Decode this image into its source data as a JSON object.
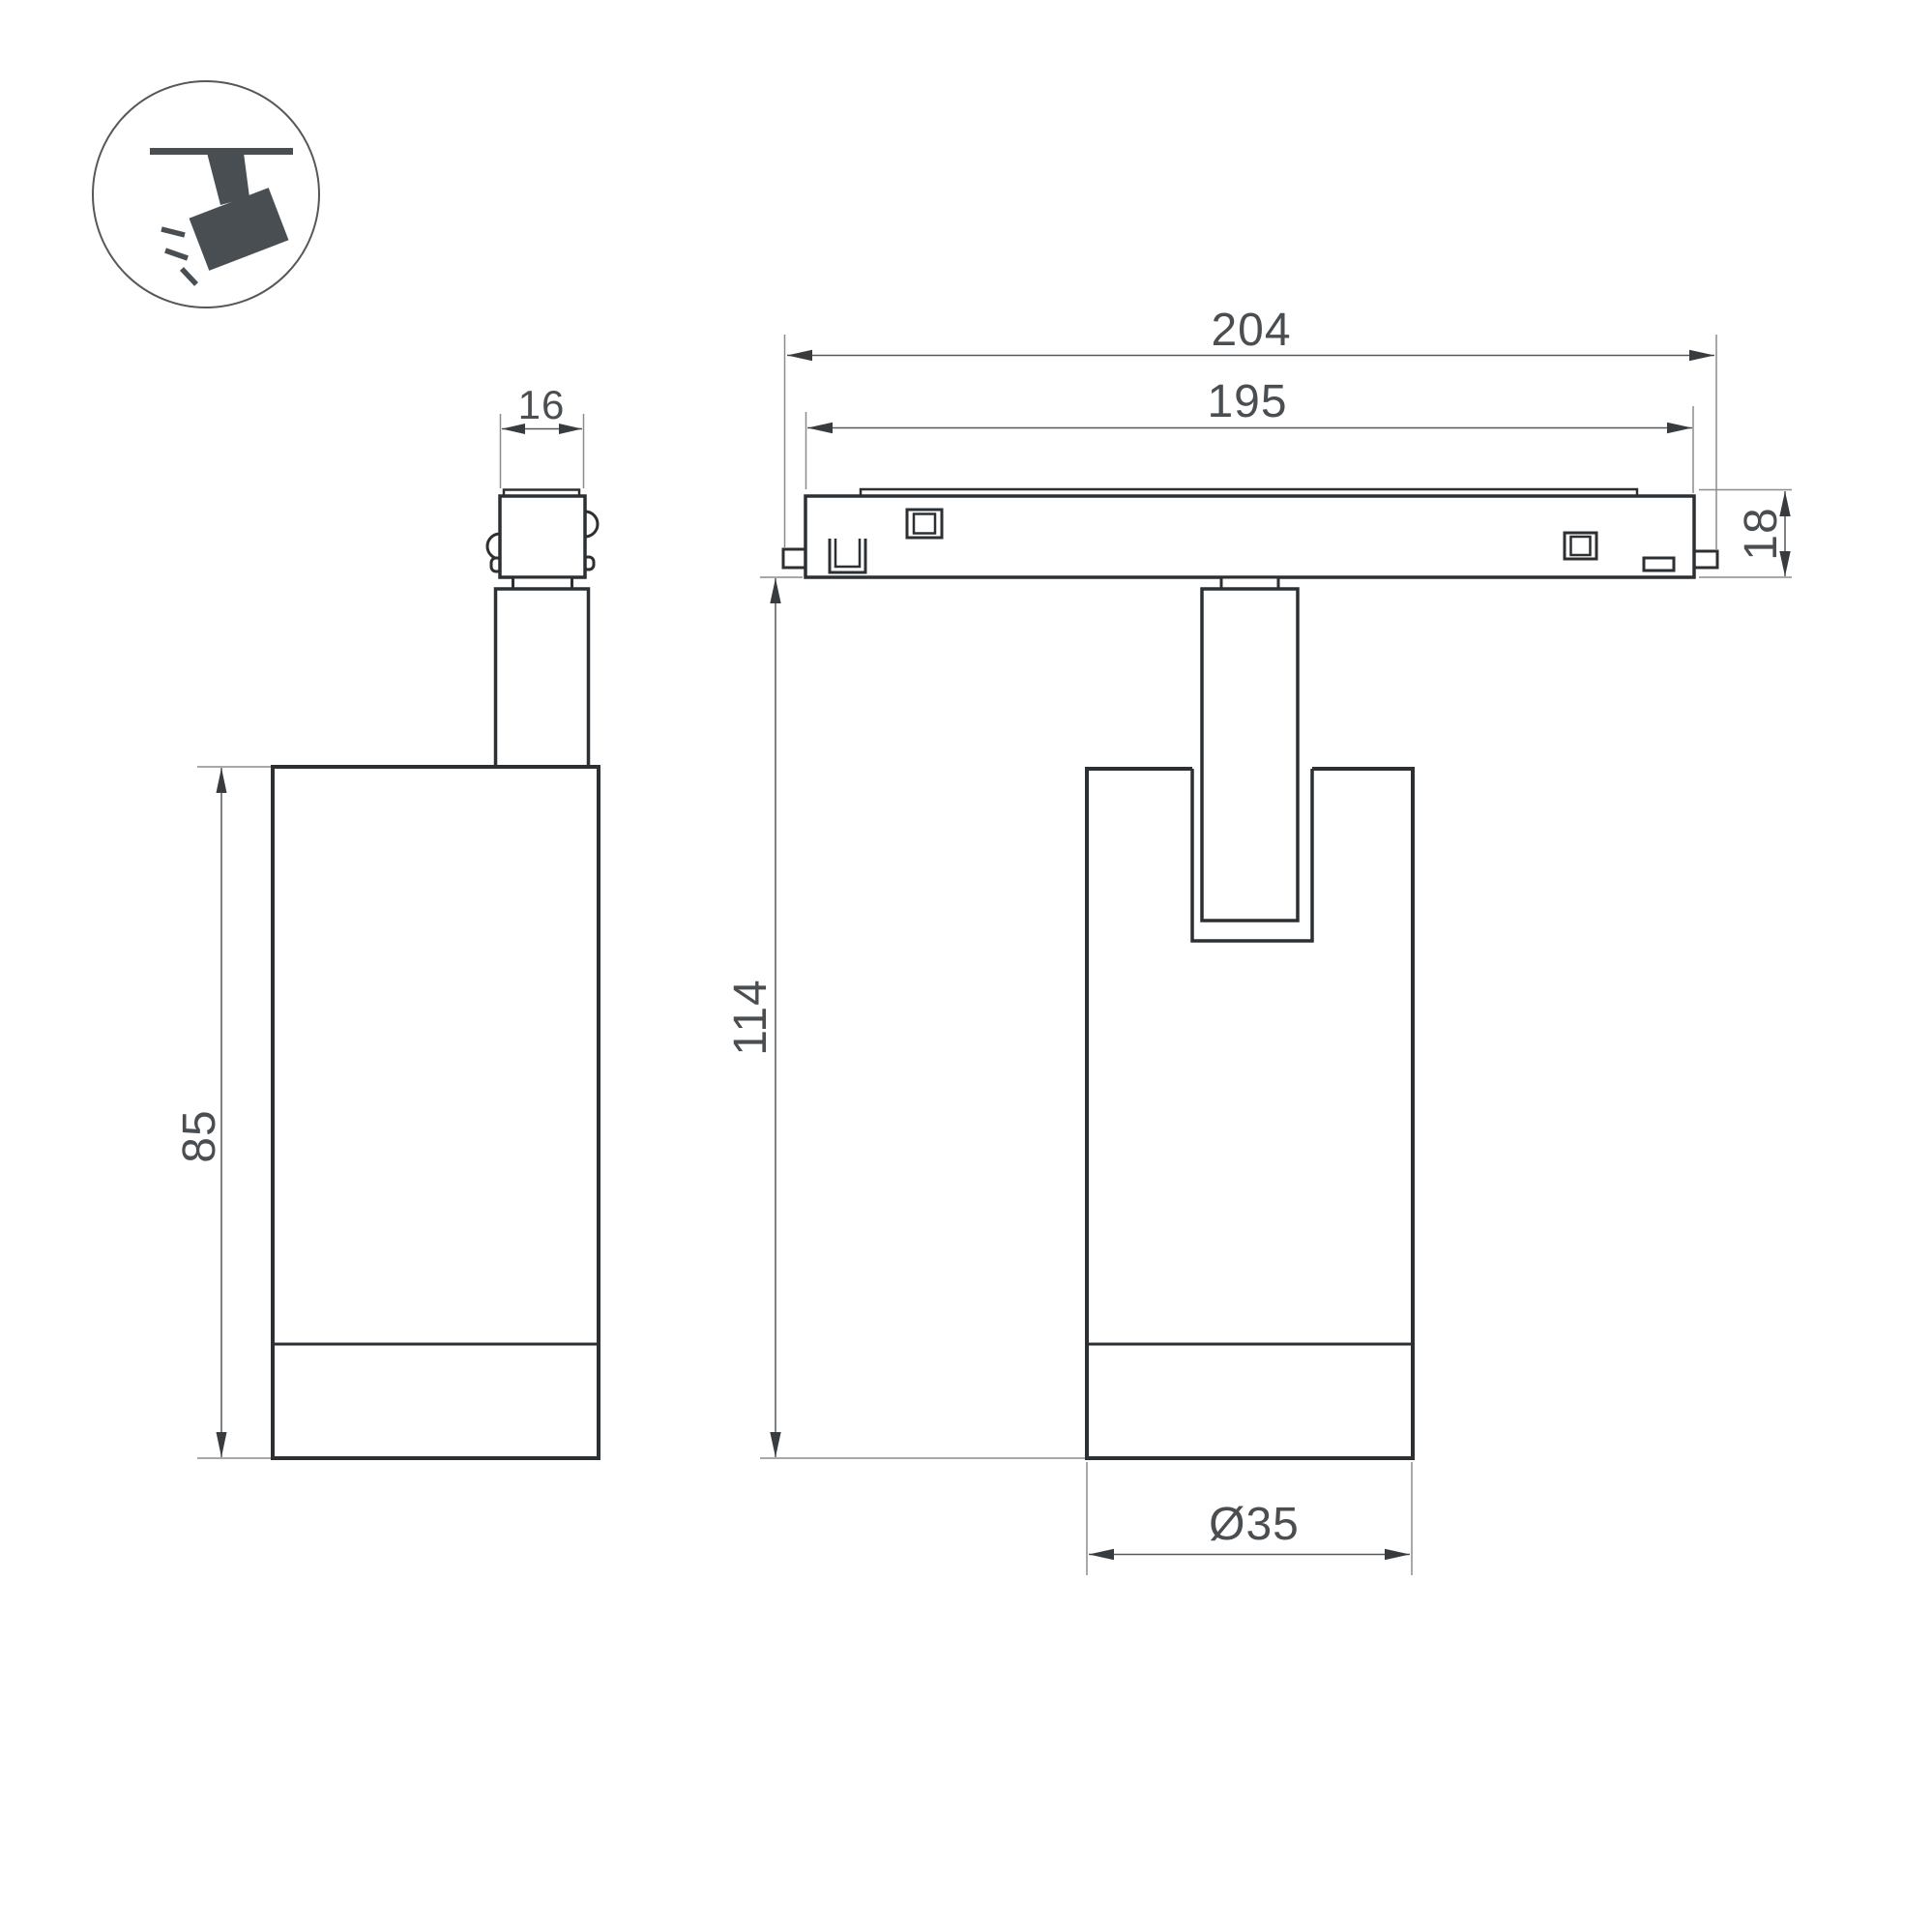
{
  "icon": {
    "name": "ceiling-track-spotlight-icon"
  },
  "dimensions": {
    "adapter_width": "16",
    "body_height": "85",
    "track_length": "204",
    "track_inner_length": "195",
    "track_height": "18",
    "overall_height": "114",
    "body_diameter": "Ø35"
  },
  "colors": {
    "outline": "#2d3033",
    "dimension_line": "#55585b",
    "extension_line": "#8c8c8c",
    "arrow": "#393c3f",
    "text": "#4b4e51",
    "icon_fill": "#494e53",
    "background": "#ffffff"
  }
}
